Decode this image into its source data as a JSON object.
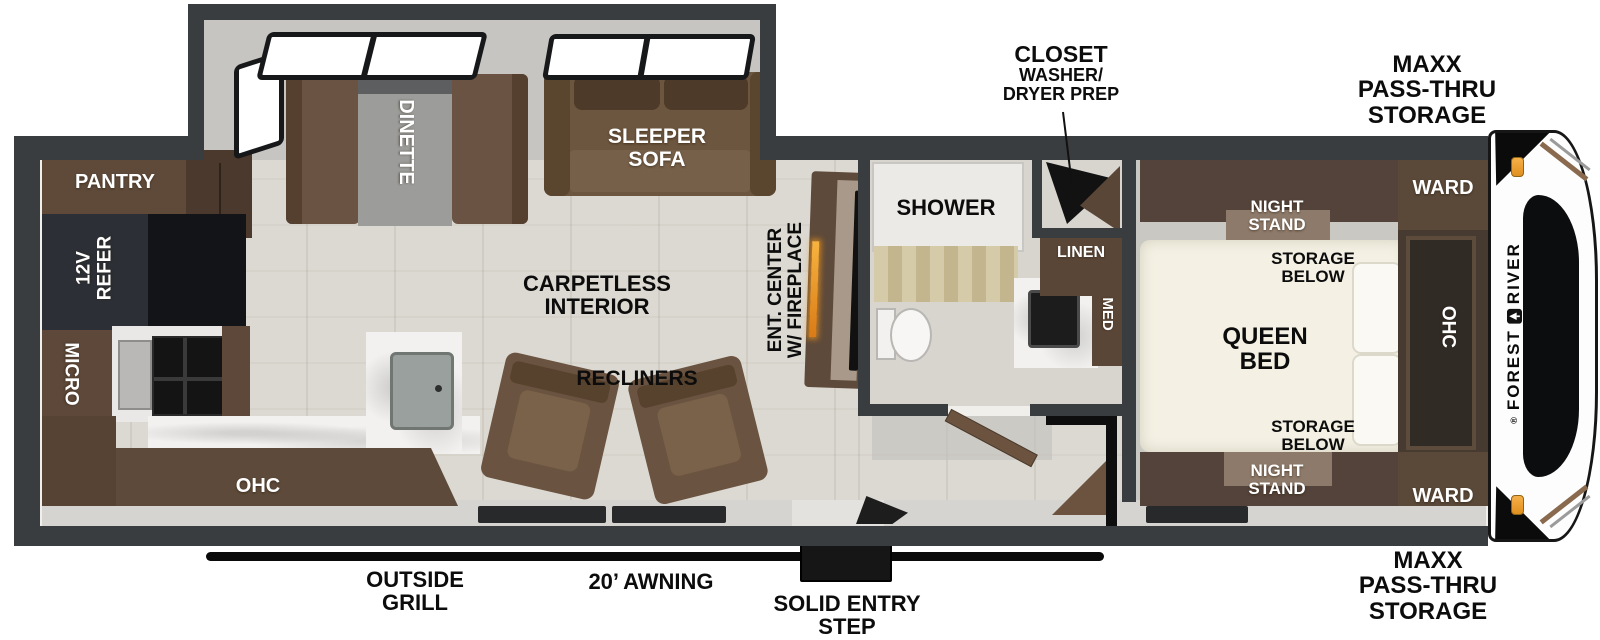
{
  "plan": {
    "brand": {
      "reg": "®",
      "word1": "FOREST",
      "word2": "RIVER"
    },
    "callouts": {
      "closet": [
        "CLOSET",
        "WASHER/",
        "DRYER PREP"
      ],
      "maxx_storage_top": [
        "MAXX",
        "PASS-THRU",
        "STORAGE"
      ],
      "maxx_storage_bottom": [
        "MAXX",
        "PASS-THRU",
        "STORAGE"
      ],
      "outside_grill": [
        "OUTSIDE",
        "GRILL"
      ],
      "awning": "20’ AWNING",
      "entry_step": [
        "SOLID ENTRY",
        "STEP"
      ]
    },
    "bedroom": {
      "queen_bed": [
        "QUEEN",
        "BED"
      ],
      "night_stand_top": [
        "NIGHT",
        "STAND"
      ],
      "night_stand_bottom": [
        "NIGHT",
        "STAND"
      ],
      "storage_below_top": [
        "STORAGE",
        "BELOW"
      ],
      "storage_below_bottom": [
        "STORAGE",
        "BELOW"
      ],
      "ward_top": "WARD",
      "ward_bottom": "WARD",
      "ohc": "OHC"
    },
    "bathroom": {
      "shower": "SHOWER",
      "linen": "LINEN",
      "med": "MED"
    },
    "living": {
      "sleeper_sofa": [
        "SLEEPER",
        "SOFA"
      ],
      "dinette": "DINETTE",
      "ent_center": [
        "ENT. CENTER",
        "W/ FIREPLACE"
      ],
      "carpetless": [
        "CARPETLESS",
        "INTERIOR"
      ],
      "recliners": "RECLINERS"
    },
    "kitchen": {
      "pantry": "PANTRY",
      "refer": [
        "12V",
        "REFER"
      ],
      "micro": "MICRO",
      "ohc": "OHC"
    },
    "colors": {
      "wall": "#3a3d40",
      "cabinet_brown": "#5d4a3a",
      "sofa_brown": "#6d563f",
      "bed_cream": "#f4f1e4",
      "floor_wood": "#dcd9d2",
      "floor_gray": "#c7c5c1",
      "marble": "#f2f1ef",
      "marker_light_orange": "#f0a43c",
      "fireplace_glow": "#e8921f",
      "awning_black": "#0a0a0a"
    }
  }
}
